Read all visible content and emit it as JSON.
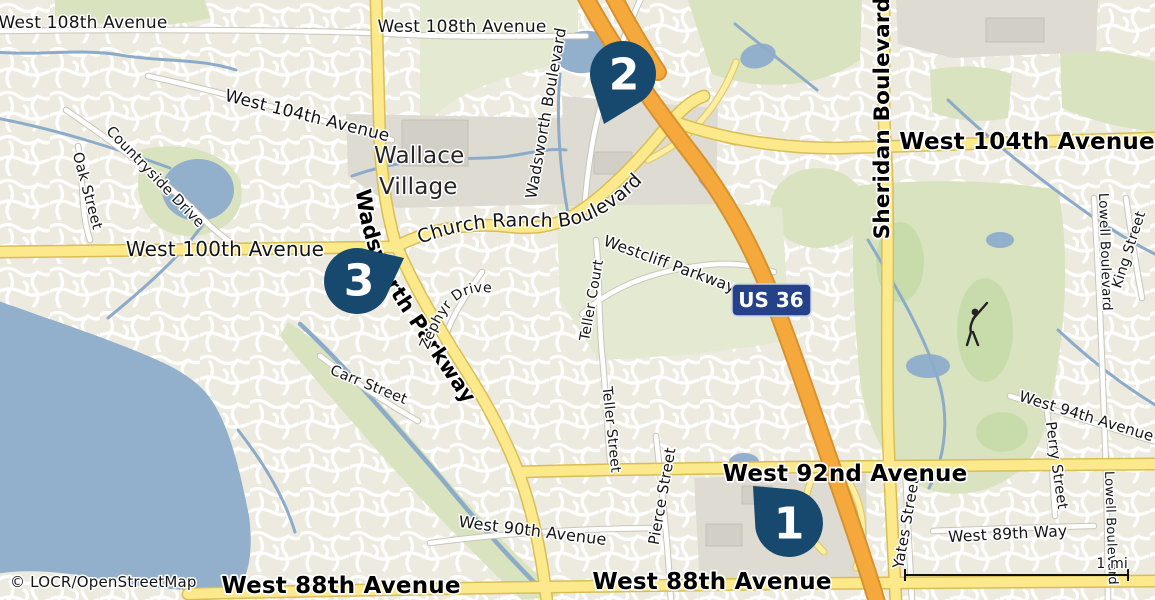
{
  "map": {
    "attribution": "© LOCR/OpenStreetMap",
    "scale_label": "1 mi",
    "route_shield": "US 36",
    "place_labels": {
      "wallace_village_line1": "Wallace",
      "wallace_village_line2": "Village"
    },
    "markers": [
      {
        "id": 1,
        "label": "1"
      },
      {
        "id": 2,
        "label": "2"
      },
      {
        "id": 3,
        "label": "3"
      }
    ],
    "road_labels": {
      "west_108th_left": "West 108th Avenue",
      "west_108th_center": "West 108th Avenue",
      "west_104th_left": "West 104th Avenue",
      "west_104th_right": "West 104th Avenue",
      "west_100th": "West 100th Avenue",
      "church_ranch_boulevard": "Church Ranch Boulevard",
      "wadsworth_parkway": "Wadsworth Parkway",
      "wadsworth_boulevard": "Wadsworth Boulevard",
      "sheridan_boulevard": "Sheridan Boulevard",
      "westcliff_parkway": "Westcliff Parkway",
      "teller_court": "Teller Court",
      "teller_street": "Teller Street",
      "zephyr_drive": "Zephyr Drive",
      "countryside_drive": "Countryside Drive",
      "oak_street": "Oak Street",
      "carr_street": "Carr Street",
      "pierce_street": "Pierce Street",
      "yates_street": "Yates Street",
      "perry_street": "Perry Street",
      "king_street": "King Street",
      "lowell_boulevard_top": "Lowell Boulevard",
      "lowell_boulevard_bottom": "Lowell Boulevard",
      "west_94th_avenue": "West 94th Avenue",
      "west_92nd_avenue": "West 92nd Avenue",
      "west_90th_avenue": "West 90th Avenue",
      "west_89th_way": "West 89th Way",
      "west_88th_left": "West 88th Avenue",
      "west_88th_right": "West 88th Avenue"
    },
    "colors": {
      "marker": "#17496E",
      "shield": "#24418A",
      "motorway": "#F5A93D",
      "major_road": "#FBE98B",
      "water": "#92AFCB",
      "land": "#EDEAE0"
    }
  }
}
